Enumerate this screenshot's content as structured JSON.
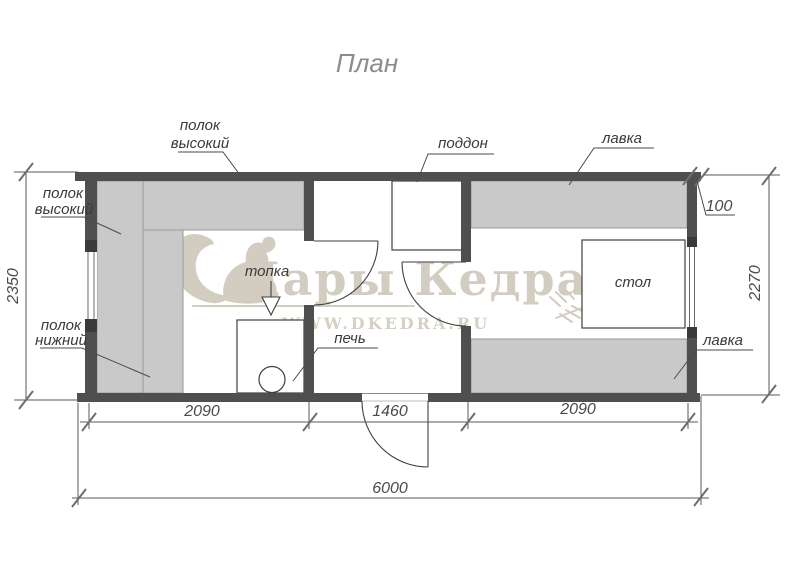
{
  "title": "План",
  "watermark": {
    "brand": "Дары Кедра",
    "website": "WWW.DKEDRA.RU",
    "color": "#d3ccc0"
  },
  "labels": {
    "polok_vysokiy_top": {
      "line1": "полок",
      "line2": "высокий"
    },
    "polok_vysokiy_left": {
      "line1": "полок",
      "line2": "высокий"
    },
    "polok_nizhniy": {
      "line1": "полок",
      "line2": "нижний"
    },
    "poddon": "поддон",
    "lavka_top": "лавка",
    "lavka_bottom": "лавка",
    "topka": "топка",
    "pech": "печь",
    "stol": "стол"
  },
  "dimensions": {
    "total_length": "6000",
    "left_room_width": "2090",
    "middle_room_width": "1460",
    "right_room_width": "2090",
    "depth_left": "2350",
    "depth_right": "2270",
    "wall_thickness": "100"
  },
  "colors": {
    "wall": "#4f4f4f",
    "furniture": "#c9c9c9",
    "drawing_line": "#3f3f3f",
    "dimension": "#4a4a4a",
    "title": "#8c8c8c",
    "watermark": "#d3ccc0"
  }
}
